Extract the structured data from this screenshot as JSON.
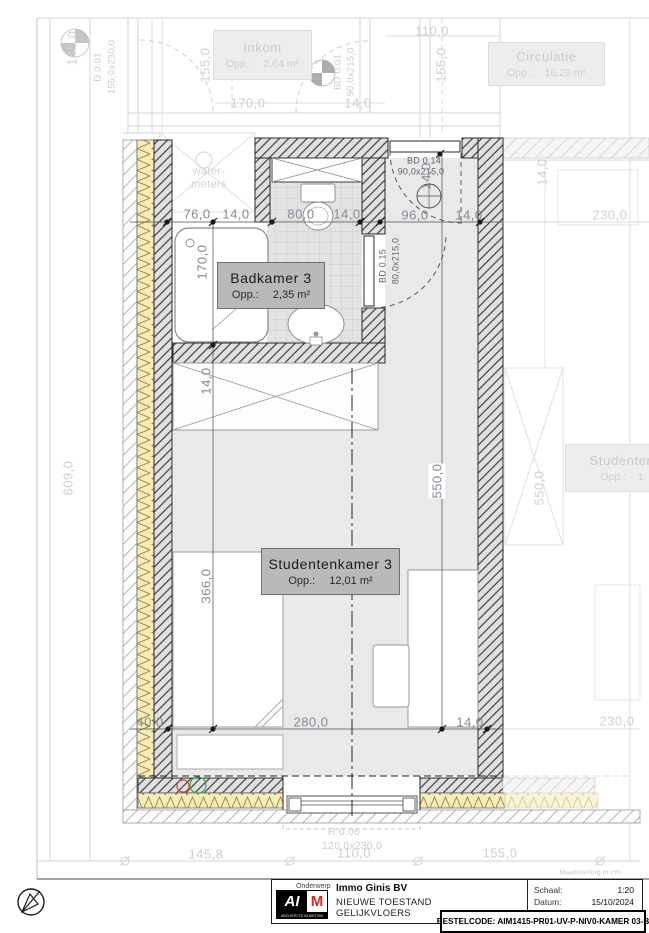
{
  "rooms": {
    "inkom": {
      "name": "Inkom",
      "opp": "Opp.:",
      "area": "2,64 m²"
    },
    "circulatie": {
      "name": "Circulatie",
      "opp": "Opp.:",
      "area": "16,29 m²"
    },
    "badkamer": {
      "name": "Badkamer 3",
      "opp": "Opp.:",
      "area": "2,35 m²"
    },
    "studentenkamer": {
      "name": "Studentenkamer 3",
      "opp": "Opp.:",
      "area": "12,01 m²"
    },
    "adjacent": {
      "name": "Studenten",
      "opp": "Opp.:",
      "area": "1"
    },
    "watermeters": {
      "line1": "water-",
      "line2": "meters"
    }
  },
  "doors": {
    "d001": {
      "code": "D 0.01",
      "size": "155,0x230,0"
    },
    "bd001": {
      "code": "BD 0.01",
      "size": "90,0x215,0"
    },
    "bd014": {
      "code": "BD 0.14",
      "size": "90,0x215,0"
    },
    "bd015": {
      "code": "BD 0.15",
      "size": "80,0x215,0"
    },
    "r006": {
      "code": "R 0.06",
      "size": "120,0x230,0"
    }
  },
  "dims": {
    "v145": "145,0",
    "v155a": "155,0",
    "h170": "170,0",
    "h14a": "14,0",
    "h110": "110,0",
    "v155b": "155,0",
    "h230a": "230,0",
    "v14f": "14,0",
    "v609": "609,0",
    "v550f": "550,0",
    "h230b": "230,0",
    "m76": "76,0",
    "m14a": "14,0",
    "m80": "80,0",
    "m14b": "14,0",
    "m96": "96,0",
    "m14c": "14,0",
    "v170": "170,0",
    "v14a": "14,0",
    "v14b": "14,0",
    "v366": "366,0",
    "v550": "550,0",
    "b40": "40,0",
    "b280": "280,0",
    "b14": "14,0",
    "f1458": "145,8",
    "f110": "110,0",
    "f155": "155,0"
  },
  "notes": {
    "maatvoering": "Maatvoering in cm"
  },
  "titleblock": {
    "onderwerp_label": "Onderwerp",
    "client": "Immo Ginis BV",
    "project1": "NIEUWE TOESTAND",
    "project2": "GELIJKVLOERS",
    "schaal_label": "Schaal:",
    "schaal": "1:20",
    "datum_label": "Datum:",
    "datum": "15/10/2024",
    "bestelcode": "BESTELCODE: AIM1415-PR01-UV-P-NIV0-KAMER 03-B",
    "logo_ai": "AI",
    "logo_m": "M",
    "logo_tagline": "ARCHITECTS IN MOTION"
  }
}
